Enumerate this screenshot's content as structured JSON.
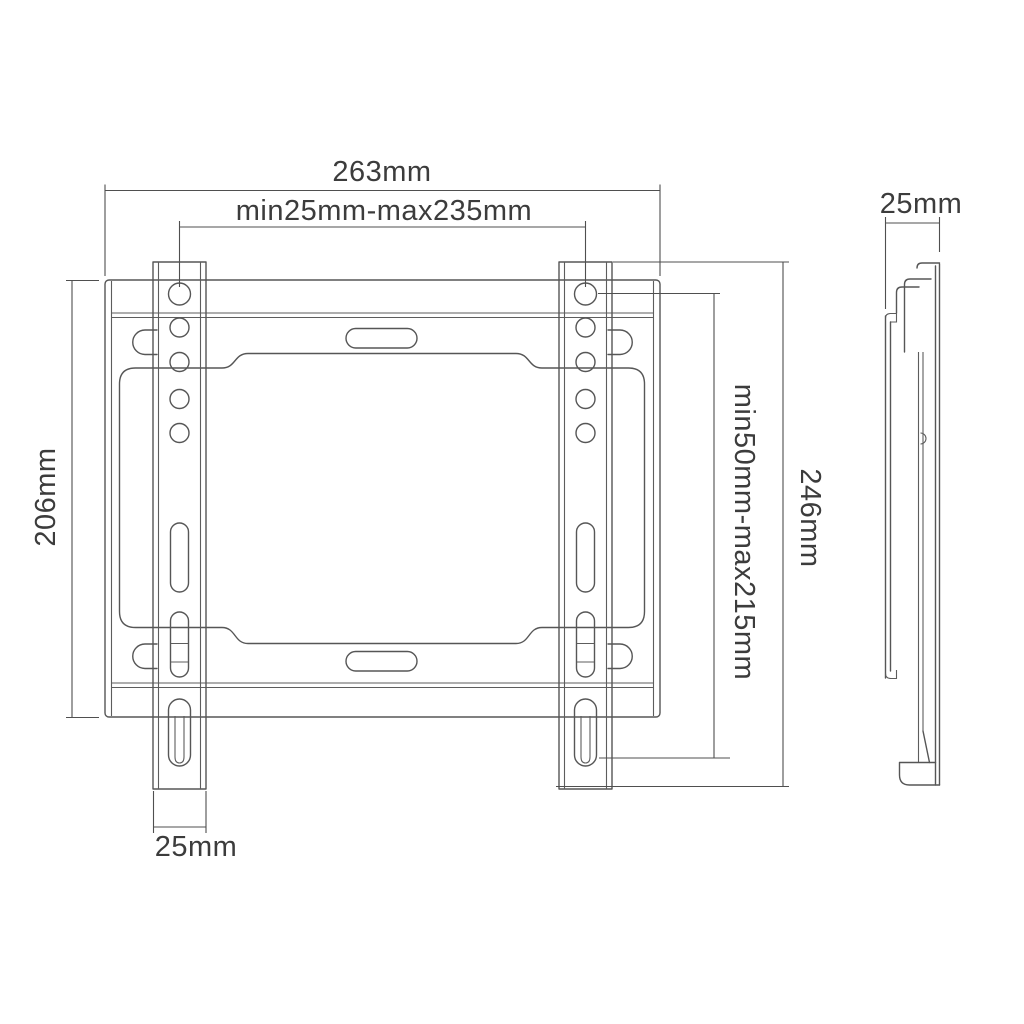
{
  "drawing": {
    "title": "TV wall mount bracket technical drawing",
    "labels": {
      "plate_width": "263mm",
      "hole_width_range": "min25mm-max235mm",
      "side_depth": "25mm",
      "plate_height": "206mm",
      "hole_height_range": "min50mm-max215mm",
      "total_height": "246mm",
      "rail_width": "25mm"
    },
    "colors": {
      "line": "#565656",
      "text": "#3c3c3c",
      "background": "#ffffff"
    }
  }
}
